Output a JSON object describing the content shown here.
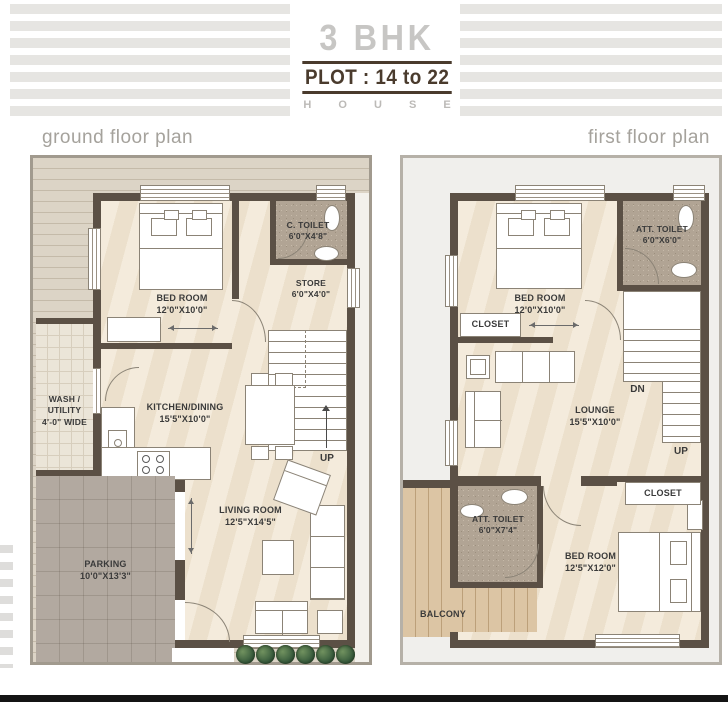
{
  "header": {
    "title": "3 BHK",
    "plot": "PLOT : 14 to 22",
    "brand": "H O U S E"
  },
  "captions": {
    "ground": "ground floor plan",
    "first": "first floor plan"
  },
  "ground": {
    "bedroom": {
      "name": "BED ROOM",
      "dims": "12'0\"X10'0\""
    },
    "ctoilet": {
      "name": "C. TOILET",
      "dims": "6'0\"X4'8\""
    },
    "store": {
      "name": "STORE",
      "dims": "6'0\"X4'0\""
    },
    "kitchen": {
      "name": "KITCHEN/DINING",
      "dims": "15'5\"X10'0\""
    },
    "wash": {
      "name": "WASH / UTILITY",
      "dims": "4'-0\" WIDE"
    },
    "living": {
      "name": "LIVING ROOM",
      "dims": "12'5\"X14'5\""
    },
    "parking": {
      "name": "PARKING",
      "dims": "10'0\"X13'3\""
    },
    "up": "UP"
  },
  "first": {
    "bedroom1": {
      "name": "BED ROOM",
      "dims": "12'0\"X10'0\""
    },
    "atoilet1": {
      "name": "ATT. TOILET",
      "dims": "6'0\"X6'0\""
    },
    "closet1": "CLOSET",
    "lounge": {
      "name": "LOUNGE",
      "dims": "15'5\"X10'0\""
    },
    "dn": "DN",
    "up": "UP",
    "atoilet2": {
      "name": "ATT. TOILET",
      "dims": "6'0\"X7'4\""
    },
    "balcony": "BALCONY",
    "bedroom2": {
      "name": "BED ROOM",
      "dims": "12'5\"X12'0\""
    },
    "closet2": "CLOSET"
  },
  "colors": {
    "accent_brown": "#4a3b2d",
    "title_gray": "#c7c6c4",
    "stripe_gray": "#e6e5e2",
    "wall": "#5b5045",
    "floor_cream": "#f1e7d4",
    "toilet_floor": "#b1a494",
    "parking_gray": "#b2a9a0",
    "balcony_wood": "#dcc5a4",
    "plant_green": "#375a3c",
    "footer_black": "#141414"
  }
}
